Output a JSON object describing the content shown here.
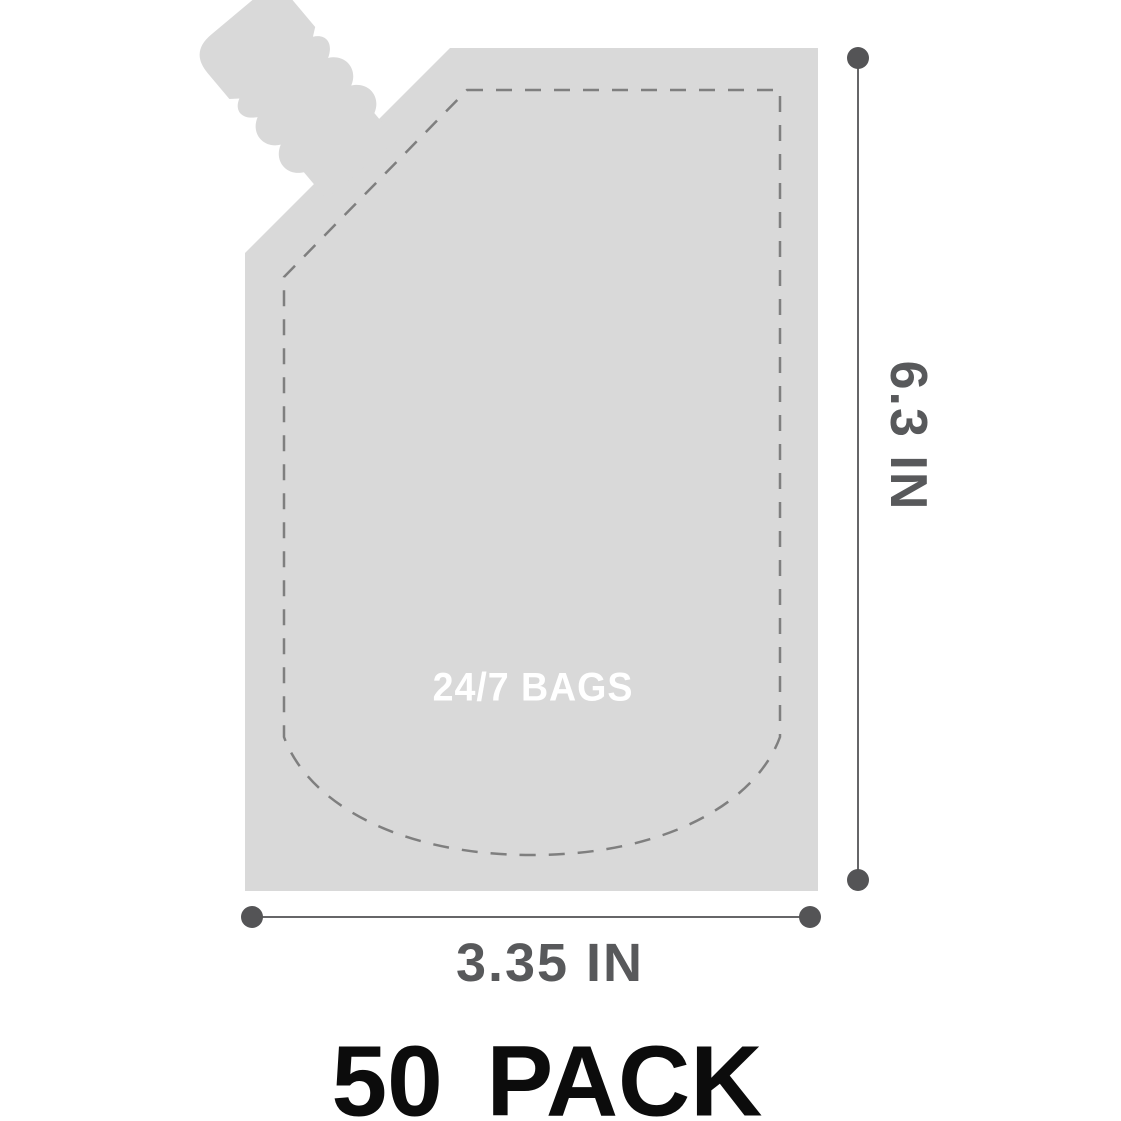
{
  "product": {
    "brand_label": "24/7 BAGS",
    "pack_label": "50 PACK"
  },
  "dimensions": {
    "height_label": "6.3 IN",
    "width_label": "3.35 IN"
  },
  "icons": {
    "pouch_silhouette": "spout-pouch-shape",
    "dimension_endpoints": "circle-dot"
  },
  "colors": {
    "bag_fill": "#d9d9d9",
    "seal_dash": "#7f7f7f",
    "dimension": "#58595b",
    "dot": "#545456",
    "pack_text": "#0c0c0c",
    "brand_text": "#ffffff",
    "background": "#ffffff"
  }
}
